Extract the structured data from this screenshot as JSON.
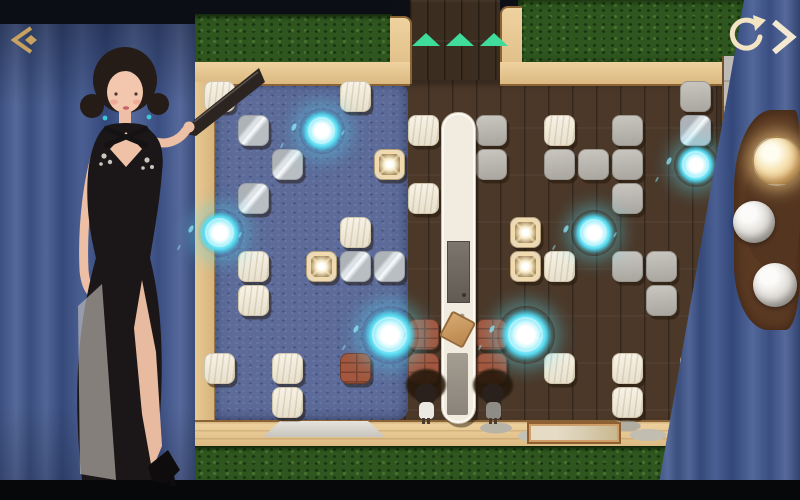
{
  "app": {
    "description": "top-down tile puzzle room with stage curtains"
  },
  "hud": {
    "back_icon": {
      "name": "back-chevron-icon",
      "color": "#c9a25f"
    },
    "restart_icon": {
      "name": "restart-circular-arrow-icon",
      "color": "#f3e5c4"
    },
    "next_icon": {
      "name": "next-chevron-icon",
      "color": "#f3e9d2"
    },
    "goal_arrows": {
      "count": 3,
      "color": "#3fdc9b",
      "direction": "up"
    }
  },
  "right_panel": {
    "spheres": [
      {
        "style": "gold",
        "state": "highlighted",
        "x": 752,
        "y": 136,
        "d": 46
      },
      {
        "style": "silver",
        "state": "normal",
        "x": 733,
        "y": 201,
        "d": 42
      },
      {
        "style": "silver",
        "state": "normal",
        "x": 753,
        "y": 263,
        "d": 44
      }
    ]
  },
  "board": {
    "grid": {
      "cols": 15,
      "rows": 10,
      "origin_x": 204,
      "origin_y": 81,
      "cell": 34,
      "tile": 31
    },
    "tiles": [
      {
        "c": 0,
        "r": 0,
        "type": "wood-white"
      },
      {
        "c": 4,
        "r": 0,
        "type": "wood-white"
      },
      {
        "c": 14,
        "r": 0,
        "type": "stone-gray"
      },
      {
        "c": 1,
        "r": 1,
        "type": "mirror"
      },
      {
        "c": 6,
        "r": 1,
        "type": "wood-white"
      },
      {
        "c": 8,
        "r": 1,
        "type": "stone-gray"
      },
      {
        "c": 10,
        "r": 1,
        "type": "wood-white"
      },
      {
        "c": 12,
        "r": 1,
        "type": "stone-gray"
      },
      {
        "c": 14,
        "r": 1,
        "type": "mirror"
      },
      {
        "c": 2,
        "r": 2,
        "type": "mirror"
      },
      {
        "c": 5,
        "r": 2,
        "type": "jewel"
      },
      {
        "c": 8,
        "r": 2,
        "type": "stone-gray"
      },
      {
        "c": 10,
        "r": 2,
        "type": "stone-gray"
      },
      {
        "c": 11,
        "r": 2,
        "type": "stone-gray"
      },
      {
        "c": 12,
        "r": 2,
        "type": "stone-gray"
      },
      {
        "c": 1,
        "r": 3,
        "type": "mirror"
      },
      {
        "c": 6,
        "r": 3,
        "type": "wood-white"
      },
      {
        "c": 12,
        "r": 3,
        "type": "stone-gray"
      },
      {
        "c": 4,
        "r": 4,
        "type": "wood-white"
      },
      {
        "c": 9,
        "r": 4,
        "type": "jewel"
      },
      {
        "c": 1,
        "r": 5,
        "type": "wood-white"
      },
      {
        "c": 3,
        "r": 5,
        "type": "jewel"
      },
      {
        "c": 4,
        "r": 5,
        "type": "mirror"
      },
      {
        "c": 5,
        "r": 5,
        "type": "mirror"
      },
      {
        "c": 9,
        "r": 5,
        "type": "jewel"
      },
      {
        "c": 10,
        "r": 5,
        "type": "wood-white"
      },
      {
        "c": 12,
        "r": 5,
        "type": "stone-gray"
      },
      {
        "c": 13,
        "r": 5,
        "type": "stone-gray"
      },
      {
        "c": 1,
        "r": 6,
        "type": "wood-white"
      },
      {
        "c": 13,
        "r": 6,
        "type": "stone-gray"
      },
      {
        "c": 6,
        "r": 7,
        "type": "brick"
      },
      {
        "c": 8,
        "r": 7,
        "type": "brick"
      },
      {
        "c": 0,
        "r": 8,
        "type": "wood-white"
      },
      {
        "c": 2,
        "r": 8,
        "type": "wood-white"
      },
      {
        "c": 4,
        "r": 8,
        "type": "brick"
      },
      {
        "c": 6,
        "r": 8,
        "type": "brick"
      },
      {
        "c": 8,
        "r": 8,
        "type": "brick"
      },
      {
        "c": 10,
        "r": 8,
        "type": "wood-white"
      },
      {
        "c": 12,
        "r": 8,
        "type": "wood-white"
      },
      {
        "c": 14,
        "r": 8,
        "type": "wood-white"
      },
      {
        "c": 2,
        "r": 9,
        "type": "wood-white"
      },
      {
        "c": 12,
        "r": 9,
        "type": "wood-white"
      }
    ],
    "orbs": [
      {
        "c": 3,
        "r": 1,
        "d": 46
      },
      {
        "c": 0,
        "r": 4,
        "d": 48
      },
      {
        "c": 14,
        "r": 2,
        "d": 44
      },
      {
        "c": 11,
        "r": 4,
        "d": 46
      },
      {
        "c": 5,
        "r": 7,
        "d": 58
      },
      {
        "c": 9,
        "r": 7,
        "d": 58
      }
    ],
    "people": [
      {
        "x": 426,
        "y": 394,
        "outfit": "#ece9e4"
      },
      {
        "x": 493,
        "y": 394,
        "outfit": "#8f8c85"
      }
    ],
    "colors": {
      "carpet": "#5c6b99",
      "floor": "#4b3829",
      "hedge": "#2f561f",
      "frame": "#e4c28f",
      "brick": "#a2573e",
      "orb_glow": "#57dcf2",
      "curtain": "#3f5484"
    }
  }
}
